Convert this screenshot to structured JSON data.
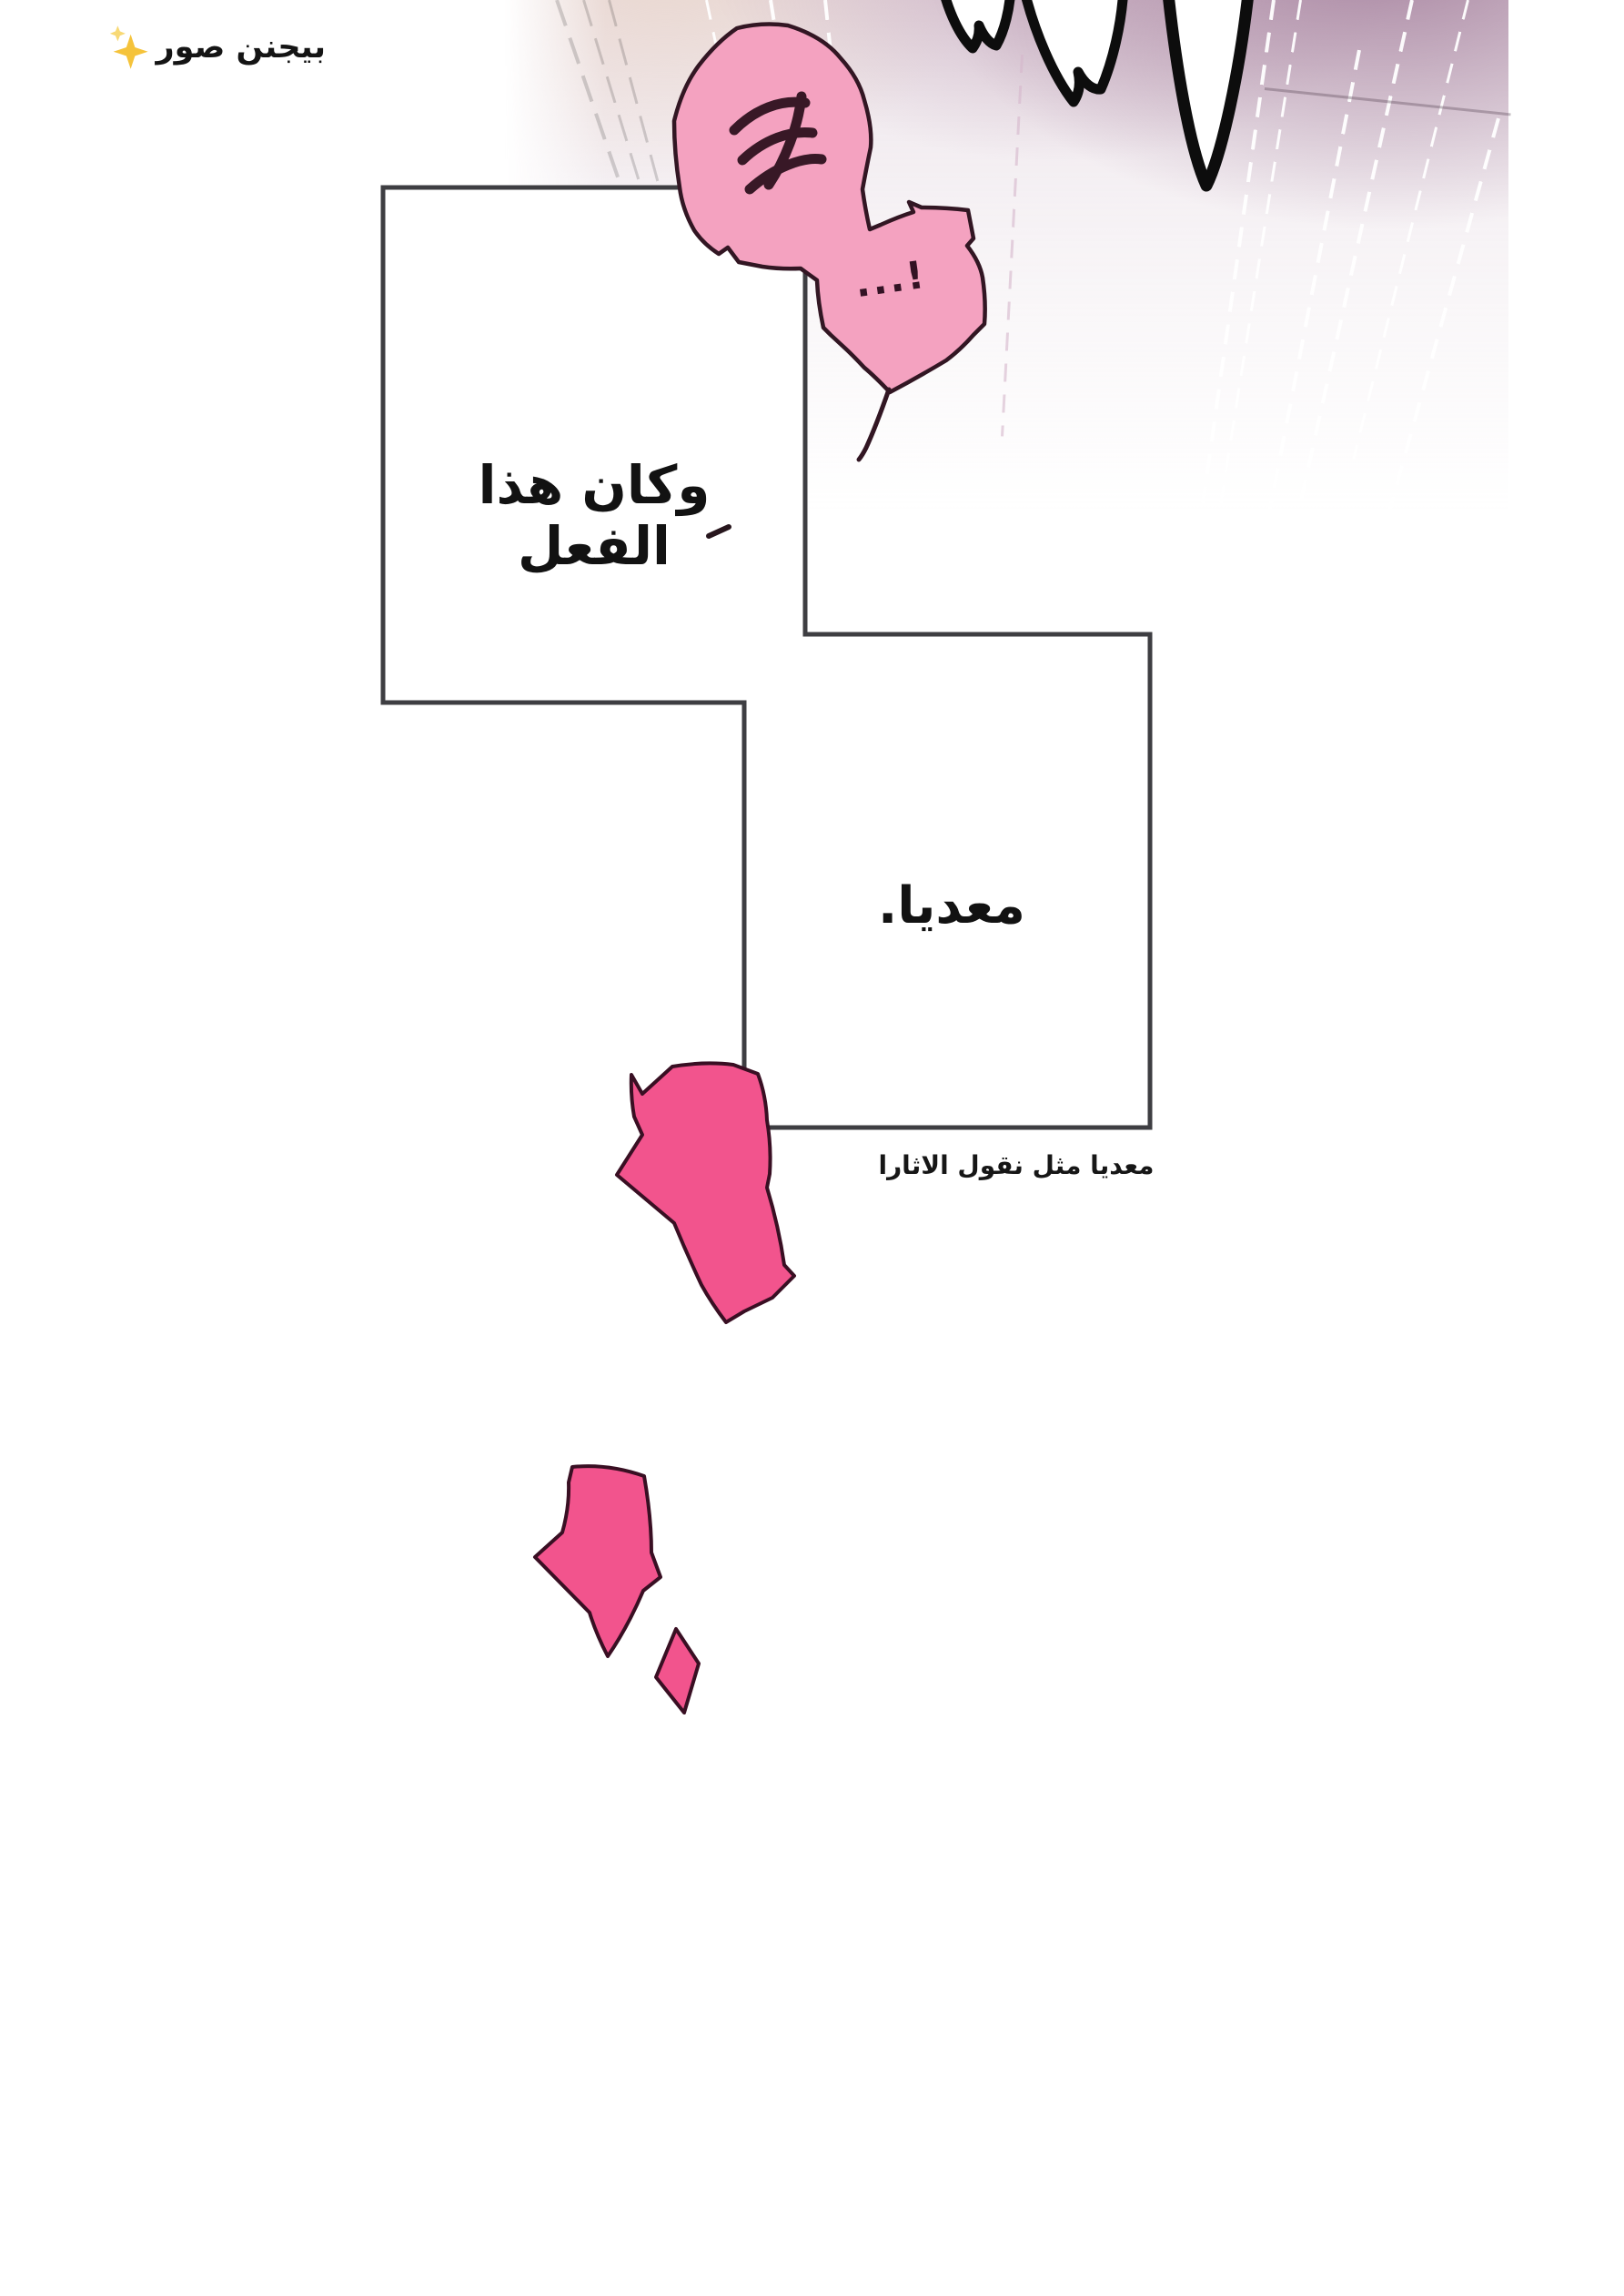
{
  "page": {
    "type": "webtoon-comic-page",
    "background": "#ffffff"
  },
  "watermark": {
    "text": "بيجنن صور",
    "icon": "sparkles",
    "color": "#141414"
  },
  "bubble": {
    "exclamation": "...!",
    "marks_icon": "laugh-scribble",
    "fill": "#f4a2c0",
    "outline": "#321623"
  },
  "panels": {
    "a_text": "وكان هذا الفعل",
    "b_text": "معديا.",
    "border_color": "#3e3e42",
    "fill": "#ffffff"
  },
  "note": {
    "text": "معديا مثل نقول الاثارا"
  },
  "splatters": {
    "fill": "#f2548d",
    "outline": "#390f23",
    "count": 3
  },
  "scene": {
    "gradient_top_color": "#a37e9b",
    "warm_tint_color": "#e9d5cb",
    "claw_fingers": "white-with-black-outline"
  }
}
